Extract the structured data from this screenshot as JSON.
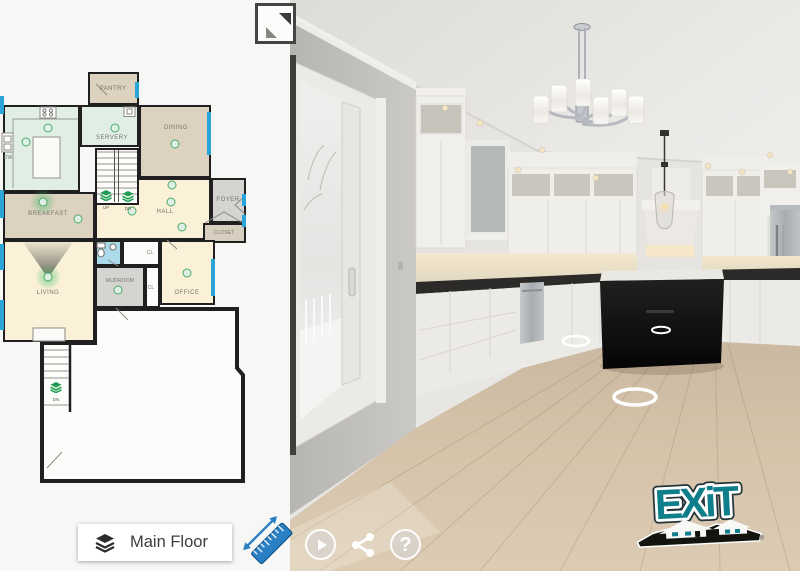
{
  "floorplan": {
    "selector_label": "Main Floor",
    "rooms": {
      "pantry": "PANTRY",
      "servery": "SERVERY",
      "dining": "DINING",
      "kitchen": "KITCHEN",
      "breakfast": "BREAKFAST",
      "hall": "HALL",
      "foyer": "FOYER",
      "closet": "CLOSET",
      "living": "LIVING",
      "mudroom": "MUDROOM",
      "office": "OFFICE",
      "garage": "GARAGE"
    },
    "small_labels": {
      "dishwasher": "DW",
      "closet_a": "CL",
      "closet_b": "CL",
      "fireplace": "F/P",
      "stairs_up": "UP",
      "stairs_down": "DN",
      "garage_stairs_down": "DN"
    },
    "colors": {
      "wall": "#202020",
      "window_blue": "#2ba4d7",
      "room_tan": "#ddd1bf",
      "room_mint": "#e0eee6",
      "room_cream": "#faf1d8",
      "room_gray": "#d5d4d0",
      "room_bath_blue": "#abdbea",
      "marker_green": "#4aa968"
    }
  },
  "icons": {
    "layers": "stacked-layers",
    "measure": "blue-ruler-45deg",
    "expand": "diagonal-resize-arrows",
    "play": "play-circle",
    "share": "share-nodes",
    "help": "question-mark"
  },
  "controls": {
    "help_glyph": "?"
  },
  "branding": {
    "logo_text": "EXiT",
    "registered_mark": "®",
    "teal": "#0e7e8a"
  }
}
